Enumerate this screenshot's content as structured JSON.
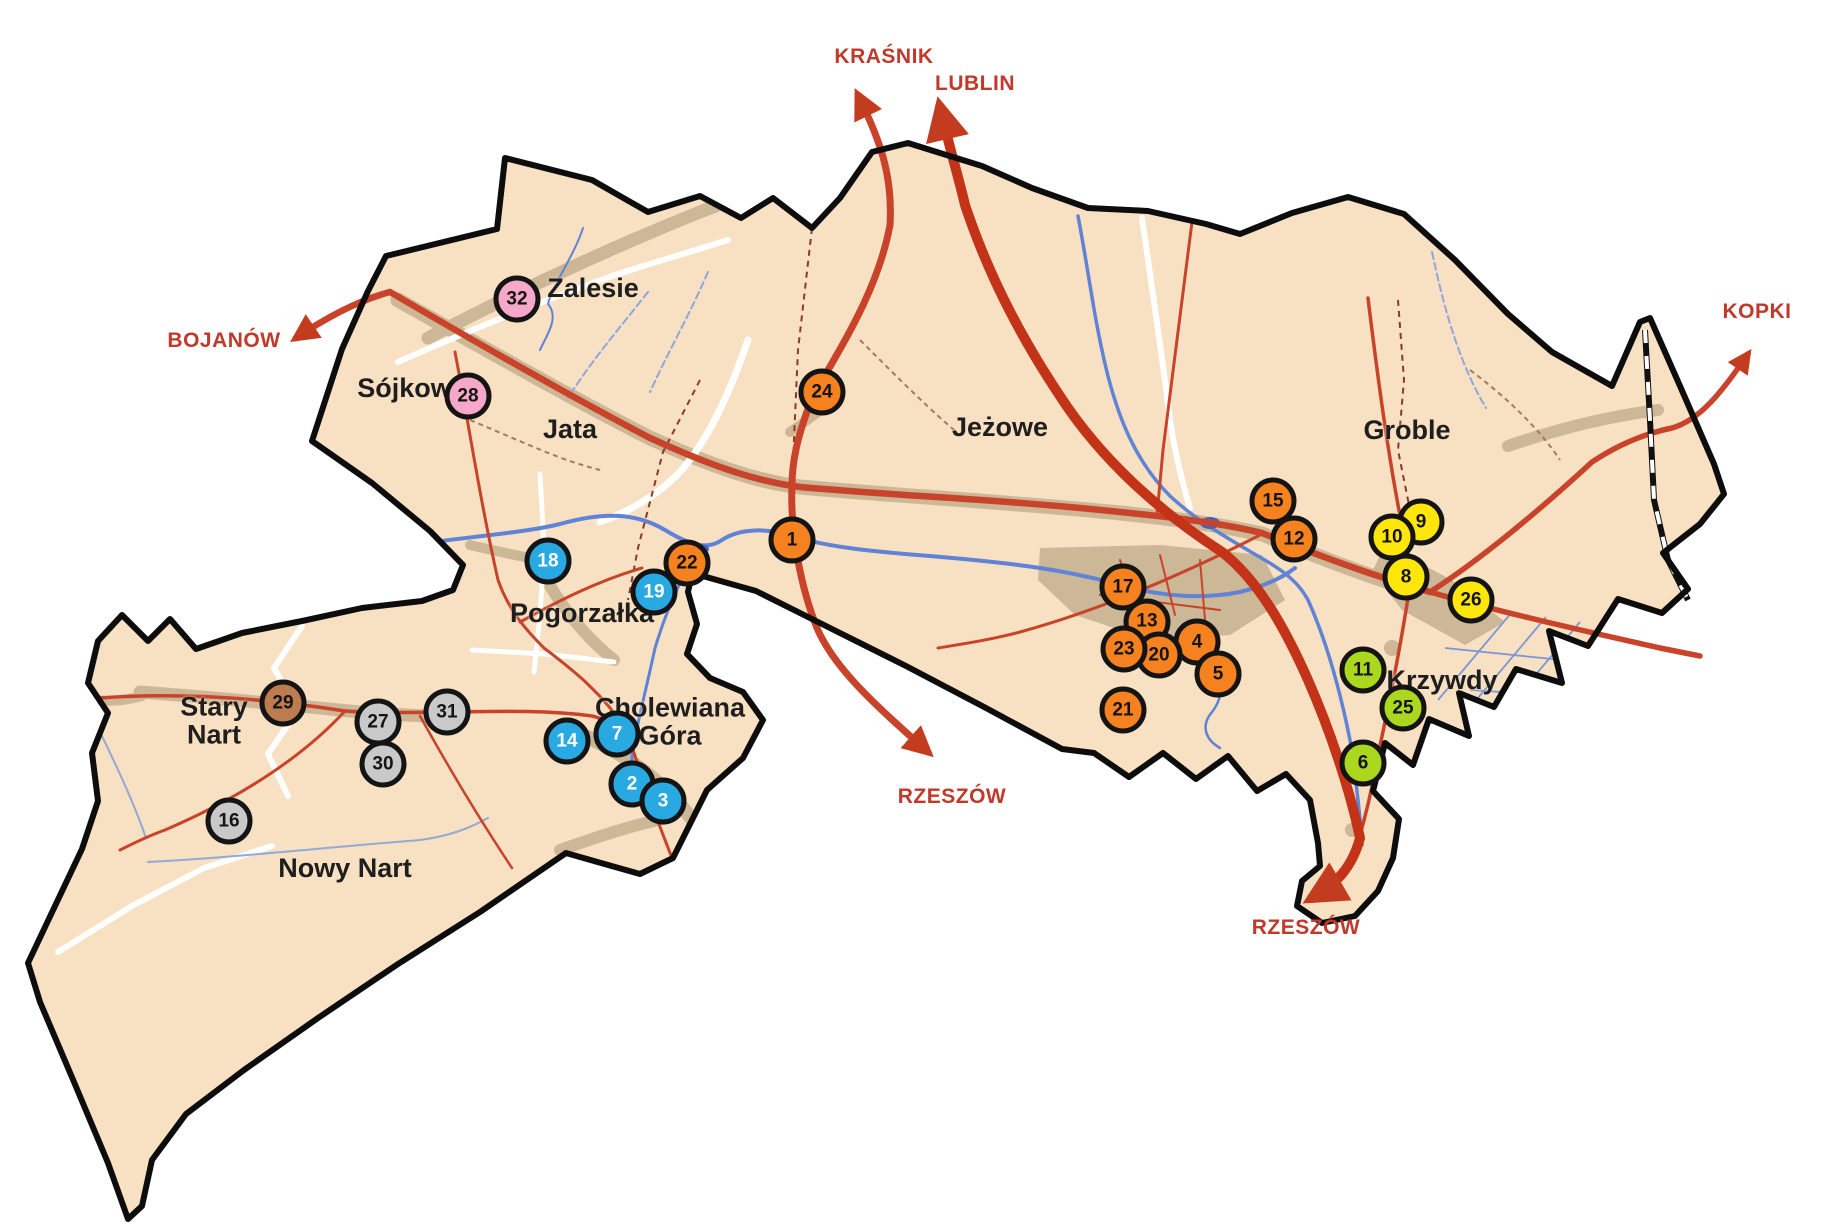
{
  "map": {
    "colors": {
      "land": "#f8e0c2",
      "boundary": "#0d0d0d",
      "road_red": "#c8432a",
      "highway_red": "#c23318",
      "built_up": "#c7b392",
      "river_blue": "#5f83d6",
      "direction_red": "#c0392b",
      "marker_border": "#141414",
      "marker_orange": "#f5821f",
      "marker_blue": "#29a9e1",
      "marker_yellow": "#ffe60a",
      "marker_green": "#abd71e",
      "marker_pink": "#f6a8c9",
      "marker_gray": "#c9c9c9",
      "marker_brown": "#bd7c50"
    },
    "places": [
      {
        "name": "Zalesie",
        "x": 593,
        "y": 288
      },
      {
        "name": "Sójkowa",
        "x": 412,
        "y": 388
      },
      {
        "name": "Jata",
        "x": 570,
        "y": 429
      },
      {
        "name": "Jeżowe",
        "x": 1000,
        "y": 427
      },
      {
        "name": "Groble",
        "x": 1407,
        "y": 430
      },
      {
        "name": "Pogorzałka",
        "x": 582,
        "y": 613
      },
      {
        "name": "Cholewiana\nGóra",
        "x": 670,
        "y": 722
      },
      {
        "name": "Stary\nNart",
        "x": 214,
        "y": 721
      },
      {
        "name": "Nowy Nart",
        "x": 345,
        "y": 868
      },
      {
        "name": "Krzywdy",
        "x": 1442,
        "y": 680
      }
    ],
    "directions": [
      {
        "label": "KRAŚNIK",
        "x": 884,
        "y": 57
      },
      {
        "label": "LUBLIN",
        "x": 975,
        "y": 84
      },
      {
        "label": "BOJANÓW",
        "x": 224,
        "y": 341
      },
      {
        "label": "KOPKI",
        "x": 1757,
        "y": 312
      },
      {
        "label": "RZESZÓW",
        "x": 952,
        "y": 797
      },
      {
        "label": "RZESZÓW",
        "x": 1306,
        "y": 928
      }
    ],
    "markers": [
      {
        "n": 1,
        "color": "orange",
        "x": 792,
        "y": 540
      },
      {
        "n": 2,
        "color": "blue",
        "x": 632,
        "y": 784
      },
      {
        "n": 3,
        "color": "blue",
        "x": 663,
        "y": 801
      },
      {
        "n": 4,
        "color": "orange",
        "x": 1197,
        "y": 642
      },
      {
        "n": 5,
        "color": "orange",
        "x": 1218,
        "y": 674
      },
      {
        "n": 6,
        "color": "green",
        "x": 1363,
        "y": 763
      },
      {
        "n": 7,
        "color": "blue",
        "x": 617,
        "y": 734
      },
      {
        "n": 8,
        "color": "yellow",
        "x": 1406,
        "y": 577
      },
      {
        "n": 9,
        "color": "yellow",
        "x": 1421,
        "y": 522
      },
      {
        "n": 10,
        "color": "yellow",
        "x": 1392,
        "y": 537
      },
      {
        "n": 11,
        "color": "green",
        "x": 1363,
        "y": 670
      },
      {
        "n": 12,
        "color": "orange",
        "x": 1294,
        "y": 539
      },
      {
        "n": 13,
        "color": "orange",
        "x": 1147,
        "y": 622
      },
      {
        "n": 14,
        "color": "blue",
        "x": 567,
        "y": 741
      },
      {
        "n": 15,
        "color": "orange",
        "x": 1273,
        "y": 501
      },
      {
        "n": 16,
        "color": "gray",
        "x": 229,
        "y": 821
      },
      {
        "n": 17,
        "color": "orange",
        "x": 1123,
        "y": 587
      },
      {
        "n": 18,
        "color": "blue",
        "x": 548,
        "y": 561
      },
      {
        "n": 19,
        "color": "blue",
        "x": 654,
        "y": 592
      },
      {
        "n": 20,
        "color": "orange",
        "x": 1159,
        "y": 655
      },
      {
        "n": 21,
        "color": "orange",
        "x": 1123,
        "y": 710
      },
      {
        "n": 22,
        "color": "orange",
        "x": 687,
        "y": 563
      },
      {
        "n": 23,
        "color": "orange",
        "x": 1124,
        "y": 649
      },
      {
        "n": 24,
        "color": "orange",
        "x": 822,
        "y": 392
      },
      {
        "n": 25,
        "color": "green",
        "x": 1403,
        "y": 708
      },
      {
        "n": 26,
        "color": "yellow",
        "x": 1471,
        "y": 600
      },
      {
        "n": 27,
        "color": "gray",
        "x": 378,
        "y": 722
      },
      {
        "n": 28,
        "color": "pink",
        "x": 468,
        "y": 396
      },
      {
        "n": 29,
        "color": "brown",
        "x": 283,
        "y": 703
      },
      {
        "n": 30,
        "color": "gray",
        "x": 383,
        "y": 764
      },
      {
        "n": 31,
        "color": "gray",
        "x": 447,
        "y": 712
      },
      {
        "n": 32,
        "color": "pink",
        "x": 517,
        "y": 299
      }
    ]
  }
}
